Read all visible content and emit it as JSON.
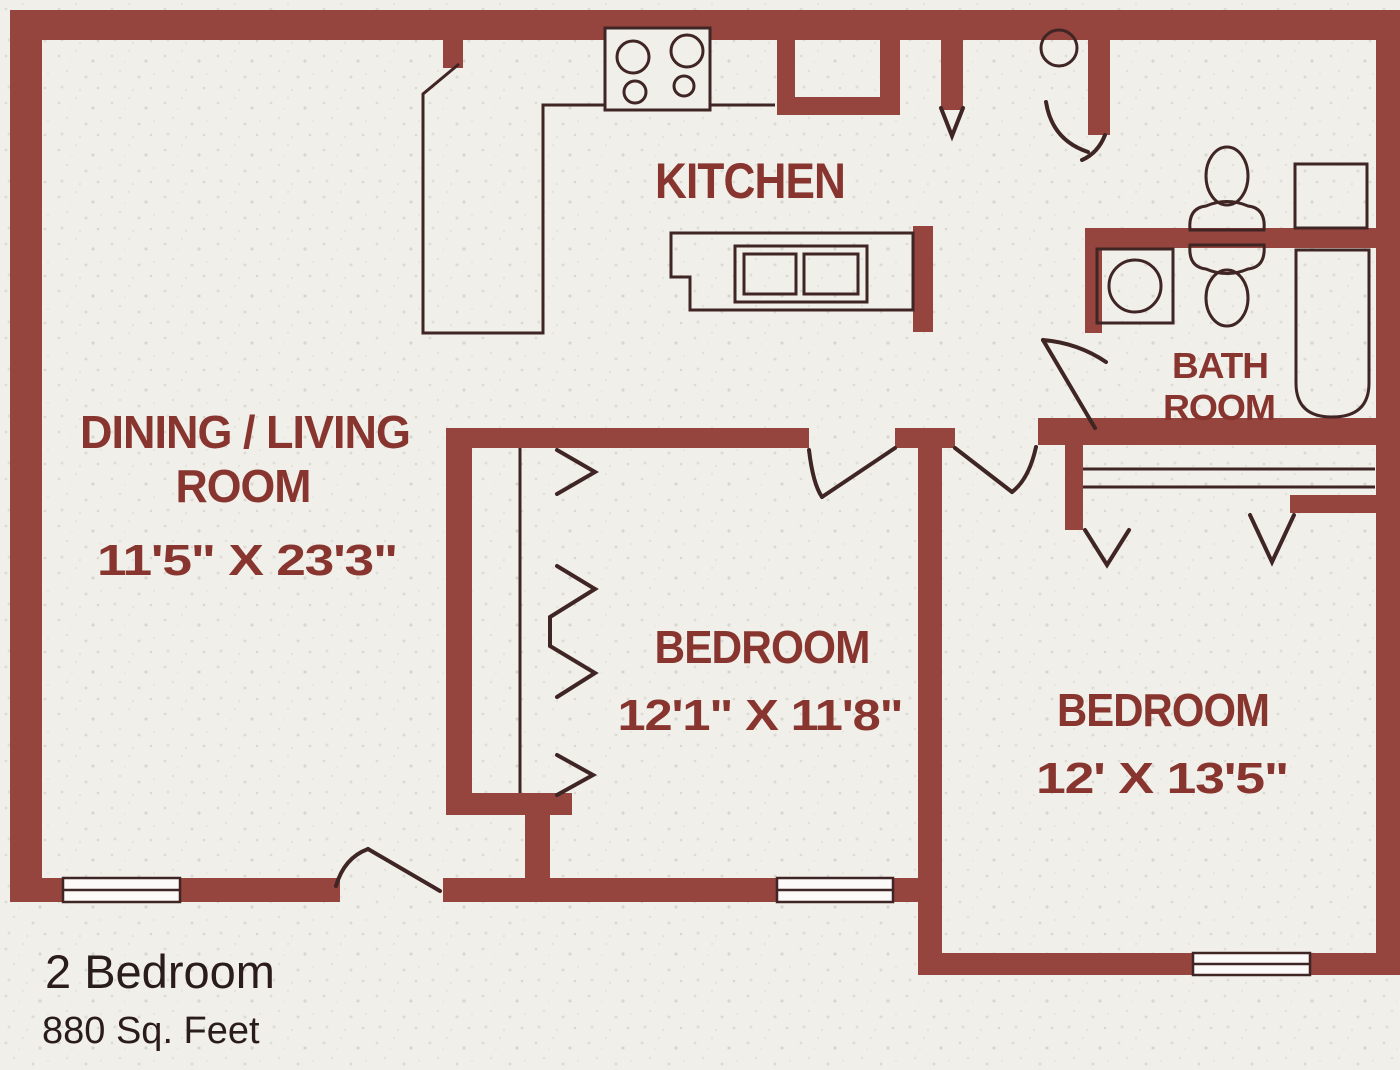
{
  "plan_title": {
    "line1": "2 Bedroom",
    "line2": "880 Sq. Feet"
  },
  "rooms": {
    "kitchen": {
      "label": "KITCHEN"
    },
    "dining_living": {
      "label_line1": "DINING / LIVING",
      "label_line2": "ROOM",
      "dimensions": "11'5\" X 23'3\""
    },
    "bedroom_1": {
      "label": "BEDROOM",
      "dimensions": "12'1\" X 11'8\""
    },
    "bedroom_2": {
      "label": "BEDROOM",
      "dimensions": "12' X 13'5\""
    },
    "bathroom": {
      "label_line1": "BATH",
      "label_line2": "ROOM"
    }
  },
  "fixtures": [
    "stove-burners-icon",
    "double-kitchen-sink-icon",
    "water-heater-icon",
    "toilet-icon",
    "toilet-icon",
    "vanity-round-sink-icon",
    "bathtub-icon",
    "medicine-cabinet-icon",
    "window-icon",
    "window-icon",
    "window-icon",
    "bifold-closet-door-icon",
    "sliding-closet-track-icon"
  ],
  "colors": {
    "wall": "#95443e",
    "line": "#3f2523",
    "label": "#87352e",
    "footer_text": "#2b1c1c",
    "background": "#f1efea"
  }
}
